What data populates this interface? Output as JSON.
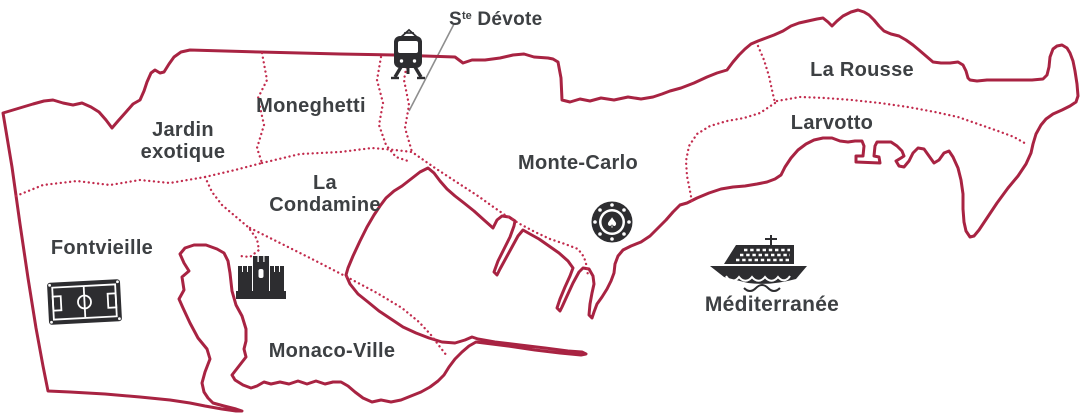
{
  "colors": {
    "background": "#ffffff",
    "border": "#a82342",
    "district_border": "#c22b4d",
    "label": "#3d4043",
    "icon": "#2d2d30",
    "leader": "#8e8e8e"
  },
  "districts": [
    {
      "id": "jardin-exotique",
      "label": "Jardin exotique"
    },
    {
      "id": "moneghetti",
      "label": "Moneghetti"
    },
    {
      "id": "la-condamine",
      "label": "La Condamine"
    },
    {
      "id": "monte-carlo",
      "label": "Monte-Carlo"
    },
    {
      "id": "fontvieille",
      "label": "Fontvieille"
    },
    {
      "id": "monaco-ville",
      "label": "Monaco-Ville"
    },
    {
      "id": "la-rousse",
      "label": "La Rousse"
    },
    {
      "id": "larvotto",
      "label": "Larvotto"
    }
  ],
  "sea": {
    "label": "Méditerranée"
  },
  "landmark": {
    "prefix": "S",
    "superscript": "te",
    "name": "Dévote"
  },
  "icons": {
    "train": "train-icon",
    "castle": "castle-icon",
    "casino": {
      "name": "casino-chip-icon",
      "glyph": "♠"
    },
    "ship": "cruise-ship-icon",
    "stadium": "football-stadium-icon"
  }
}
